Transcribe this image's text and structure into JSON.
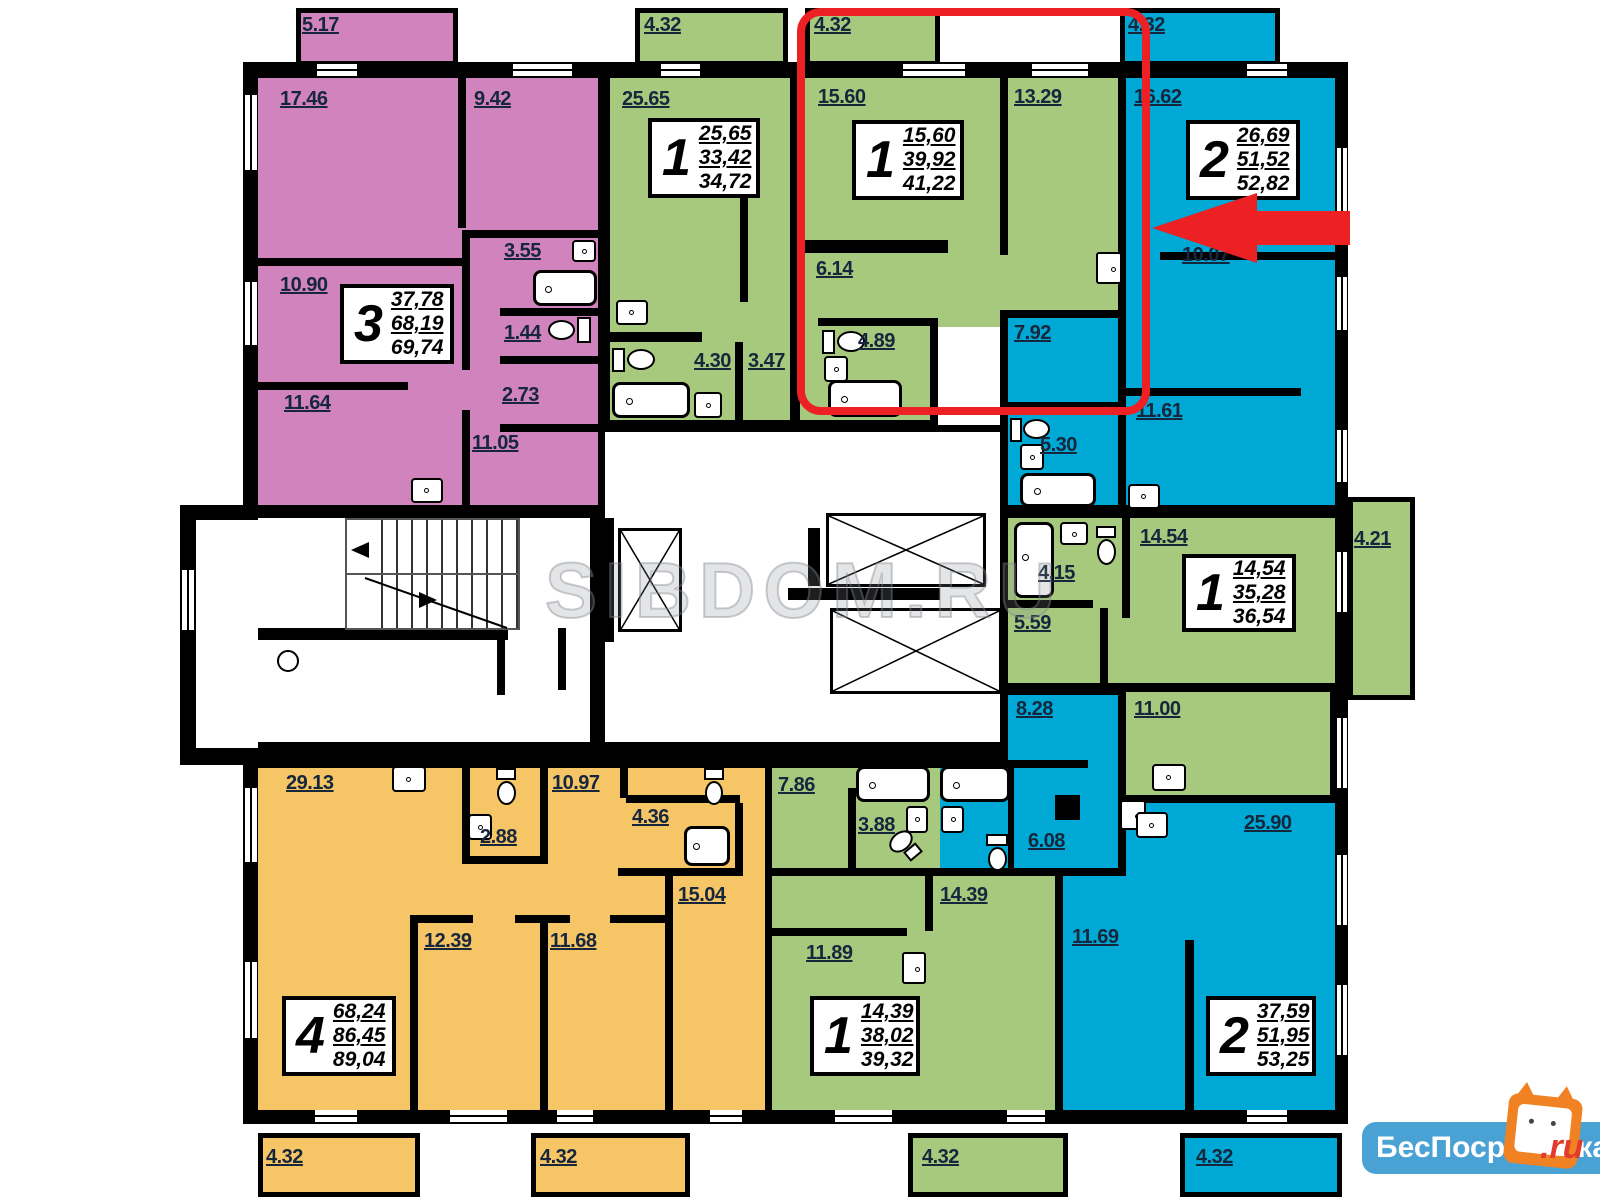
{
  "watermark": "SIBDOM.RU",
  "logo": {
    "text": "БесПосредника",
    "suffix": ".ru"
  },
  "colors": {
    "pink": "#d183bd",
    "green": "#a6c97e",
    "blue": "#00a8d5",
    "yellow": "#f5c566",
    "highlight": "#ed2024",
    "logo_blue": "#4aa2d4"
  },
  "labels": [
    "5.17",
    "17.46",
    "9.42",
    "10.90",
    "3.55",
    "1.44",
    "2.73",
    "11.64",
    "11.05",
    "4.32",
    "25.65",
    "4.30",
    "3.47",
    "4.32",
    "15.60",
    "13.29",
    "6.14",
    "4.89",
    "4.32",
    "16.62",
    "10.07",
    "7.92",
    "11.61",
    "5.30",
    "14.54",
    "4.21",
    "4.15",
    "5.59",
    "11.00",
    "8.28",
    "25.90",
    "6.08",
    "11.69",
    "4.32",
    "29.13",
    "10.97",
    "2.88",
    "4.36",
    "15.04",
    "12.39",
    "11.68",
    "4.32",
    "4.32",
    "7.86",
    "3.88",
    "14.39",
    "11.89",
    "4.32"
  ],
  "info_boxes": [
    {
      "rooms": "3",
      "v1": "37,78",
      "v2": "68,19",
      "v3": "69,74"
    },
    {
      "rooms": "1",
      "v1": "25,65",
      "v2": "33,42",
      "v3": "34,72"
    },
    {
      "rooms": "1",
      "v1": "15,60",
      "v2": "39,92",
      "v3": "41,22"
    },
    {
      "rooms": "2",
      "v1": "26,69",
      "v2": "51,52",
      "v3": "52,82"
    },
    {
      "rooms": "1",
      "v1": "14,54",
      "v2": "35,28",
      "v3": "36,54"
    },
    {
      "rooms": "4",
      "v1": "68,24",
      "v2": "86,45",
      "v3": "89,04"
    },
    {
      "rooms": "1",
      "v1": "14,39",
      "v2": "38,02",
      "v3": "39,32"
    },
    {
      "rooms": "2",
      "v1": "37,59",
      "v2": "51,95",
      "v3": "53,25"
    }
  ]
}
